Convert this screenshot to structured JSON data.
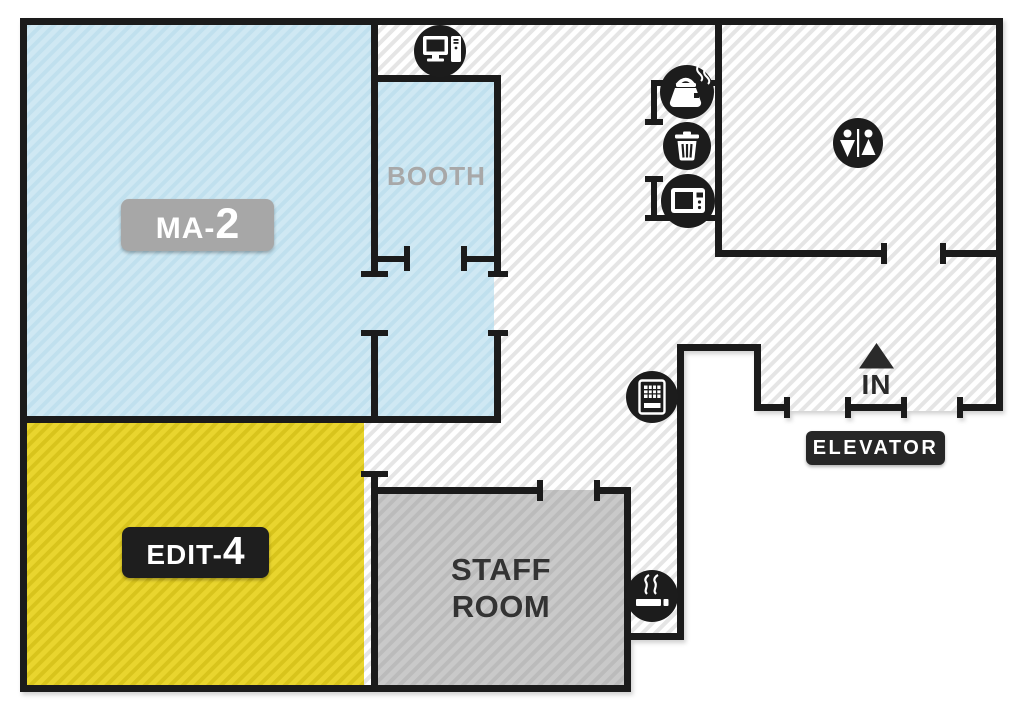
{
  "scene": {
    "type": "office floor plan",
    "background": "#ffffff",
    "wall_color": "#1b1b1b",
    "hallway_stripe_color": "#e5e5e5"
  },
  "rooms": {
    "ma2": {
      "label_prefix": "MA-",
      "label_number": "2",
      "floor_color": "#cfe8f3",
      "badge_color": "#a7a7a7",
      "badge_text_color": "#ffffff"
    },
    "booth": {
      "label": "BOOTH",
      "floor_color": "#cfe8f3",
      "text_color": "#a8a8a8"
    },
    "edit4": {
      "label_prefix": "EDIT-",
      "label_number": "4",
      "floor_color": "#e8d52d",
      "badge_color": "#1e1e1e",
      "badge_text_color": "#ffffff"
    },
    "staff_room": {
      "label_line1": "STAFF",
      "label_line2": "ROOM",
      "floor_color": "#c8c8c8",
      "text_color": "#333333"
    }
  },
  "entrance": {
    "label": "IN",
    "arrow_direction": "up",
    "text_color": "#2a2a2a"
  },
  "elevator": {
    "label": "ELEVATOR",
    "badge_color": "#262626",
    "text_color": "#ffffff"
  },
  "amenity_icons": [
    {
      "id": "computer-icon",
      "location": "above booth"
    },
    {
      "id": "kettle-icon",
      "location": "kitchenette nook"
    },
    {
      "id": "trash-icon",
      "location": "kitchenette nook"
    },
    {
      "id": "microwave-icon",
      "location": "kitchenette nook"
    },
    {
      "id": "restroom-icon",
      "location": "restroom"
    },
    {
      "id": "vending-machine-icon",
      "location": "hallway"
    },
    {
      "id": "smoking-area-icon",
      "location": "corridor nook"
    }
  ]
}
